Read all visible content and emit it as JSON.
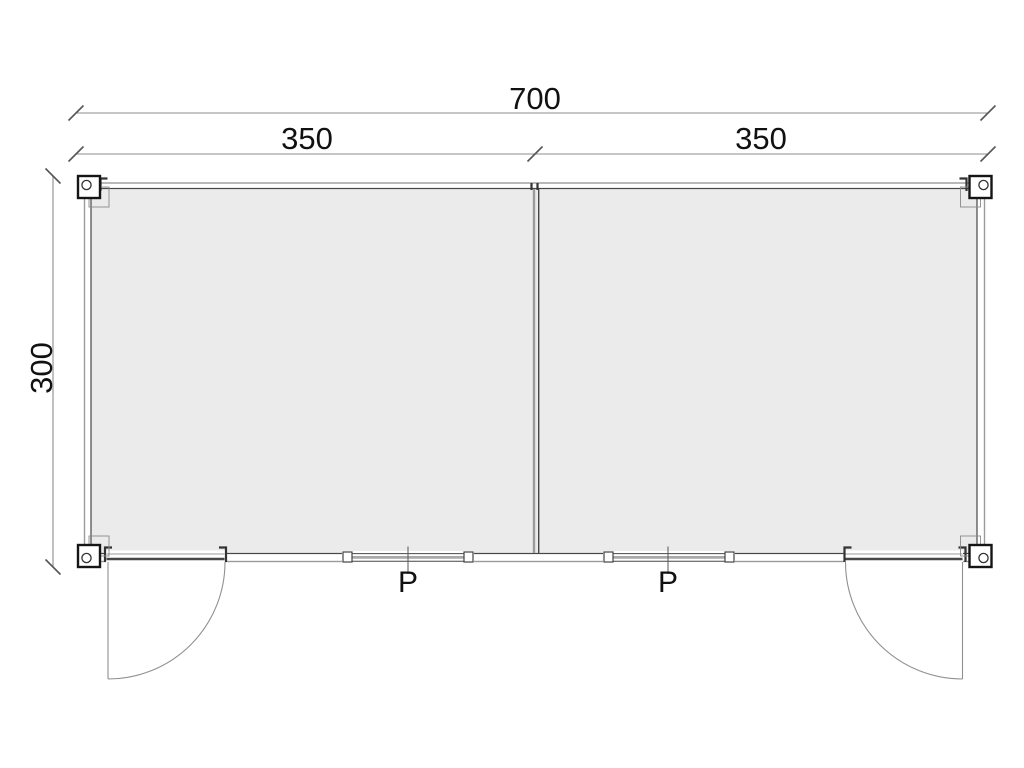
{
  "document": {
    "type": "architectural-floor-plan",
    "background": "#ffffff"
  },
  "plan": {
    "dimensions": {
      "total_width": "700",
      "left_bay": "350",
      "right_bay": "350",
      "depth": "300"
    },
    "window_labels": {
      "left": "P",
      "right": "P"
    },
    "colors": {
      "interior_fill": "#ebebeb",
      "wall_dark": "#474747",
      "wall_light": "#9b9b9b",
      "dimension_line": "#8c8c8c",
      "tick": "#555555",
      "text": "#111111",
      "corner_casting": "#151515"
    }
  }
}
